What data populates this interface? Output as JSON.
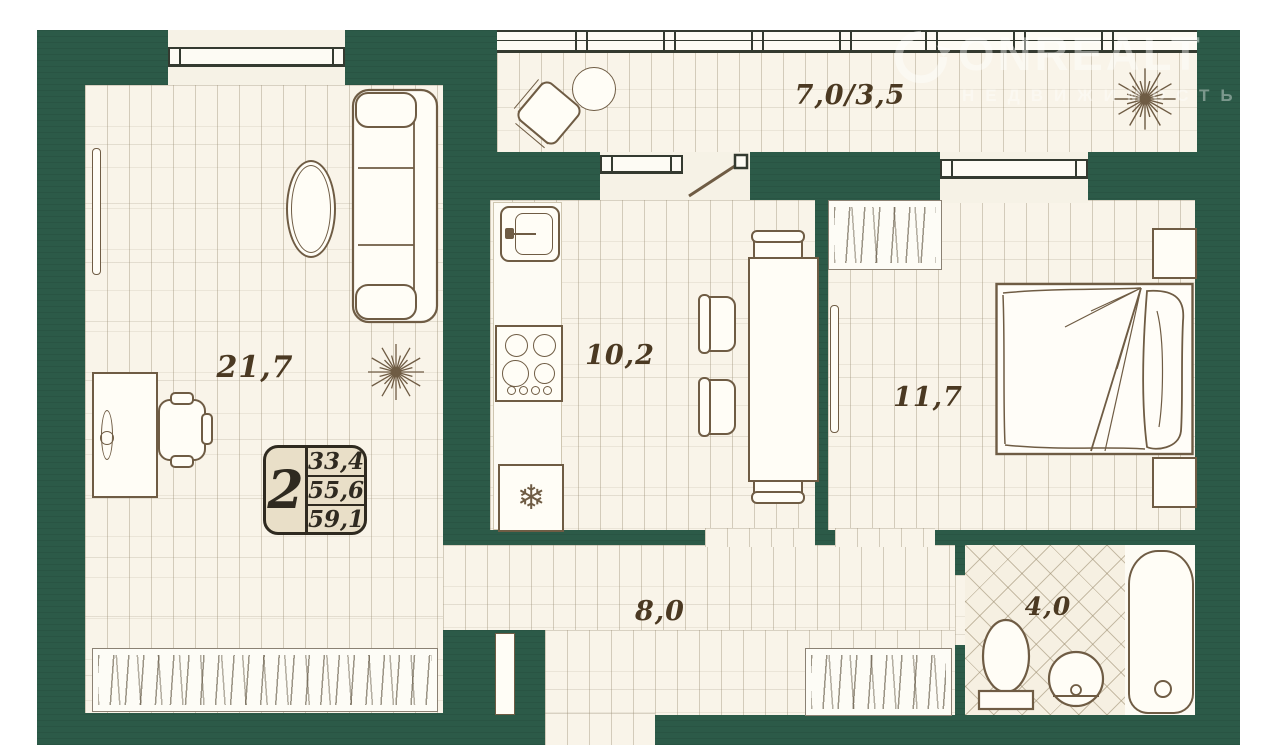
{
  "watermark": {
    "brand": "ONREALT",
    "subtitle": "НЕДВИЖИМОСТЬ"
  },
  "unit_badge": {
    "rooms": "2",
    "values": [
      "33,4",
      "55,6",
      "59,1"
    ]
  },
  "rooms": {
    "living": {
      "area": "21,7"
    },
    "kitchen": {
      "area": "10,2"
    },
    "bedroom": {
      "area": "11,7"
    },
    "hallway": {
      "area": "8,0"
    },
    "bathroom": {
      "area": "4,0"
    },
    "balcony": {
      "area": "7,0/3,5"
    }
  },
  "icons": {
    "snowflake": "❄"
  }
}
